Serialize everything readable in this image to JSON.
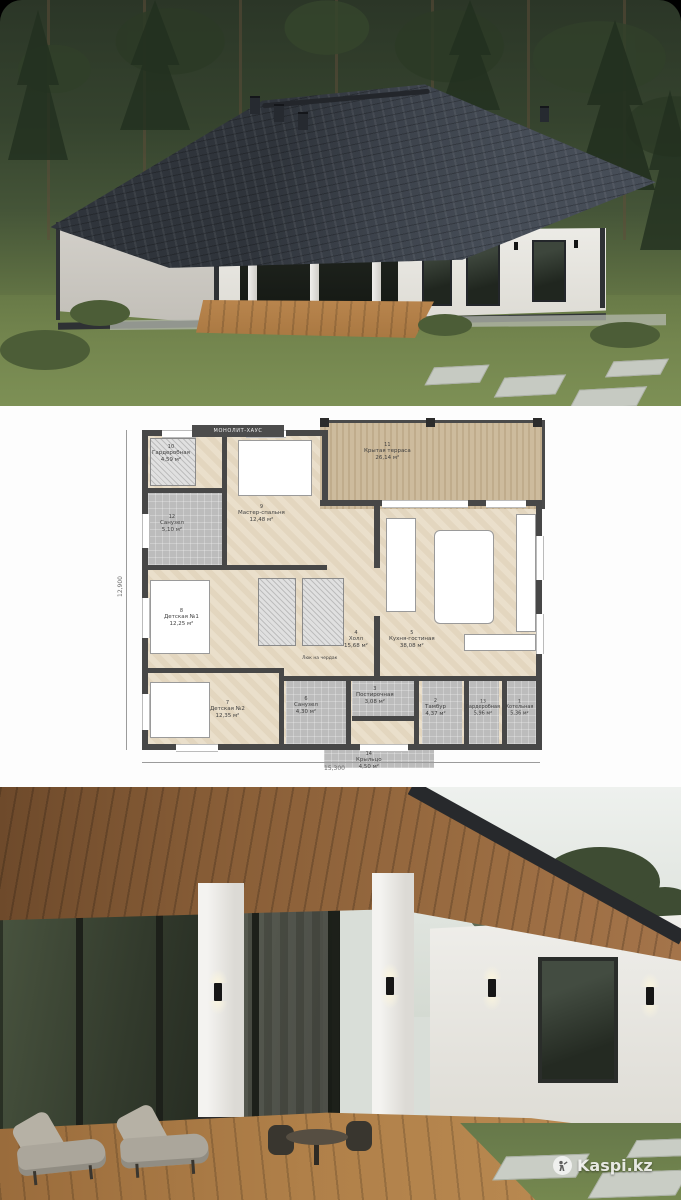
{
  "watermark": {
    "label": "Kaspi.kz"
  },
  "floorplan": {
    "brand": "МОНОЛИТ-ХАУС",
    "attic_note": "Люк на чердак",
    "dim_bottom": "15,300",
    "dim_left": "12,900",
    "rooms": [
      {
        "num": "10",
        "name": "Гардеробная",
        "area": "4,59 м²"
      },
      {
        "num": "12",
        "name": "Санузел",
        "area": "5,10 м²"
      },
      {
        "num": "9",
        "name": "Мастер-спальня",
        "area": "12,48 м²"
      },
      {
        "num": "11",
        "name": "Крытая терраса",
        "area": "26,14 м²"
      },
      {
        "num": "8",
        "name": "Детская №1",
        "area": "12,25 м²"
      },
      {
        "num": "4",
        "name": "Холл",
        "area": "15,68 м²"
      },
      {
        "num": "5",
        "name": "Кухня-гостиная",
        "area": "38,08 м²"
      },
      {
        "num": "7",
        "name": "Детская №2",
        "area": "12,35 м²"
      },
      {
        "num": "6",
        "name": "Санузел",
        "area": "4,30 м²"
      },
      {
        "num": "3",
        "name": "Постирочная",
        "area": "3,08 м²"
      },
      {
        "num": "2",
        "name": "Тамбур",
        "area": "4,37 м²"
      },
      {
        "num": "13",
        "name": "Гардеробная",
        "area": "5,96 м²"
      },
      {
        "num": "1",
        "name": "Котельная",
        "area": "5,36 м²"
      },
      {
        "num": "14",
        "name": "Крыльцо",
        "area": "4,50 м²"
      }
    ]
  }
}
